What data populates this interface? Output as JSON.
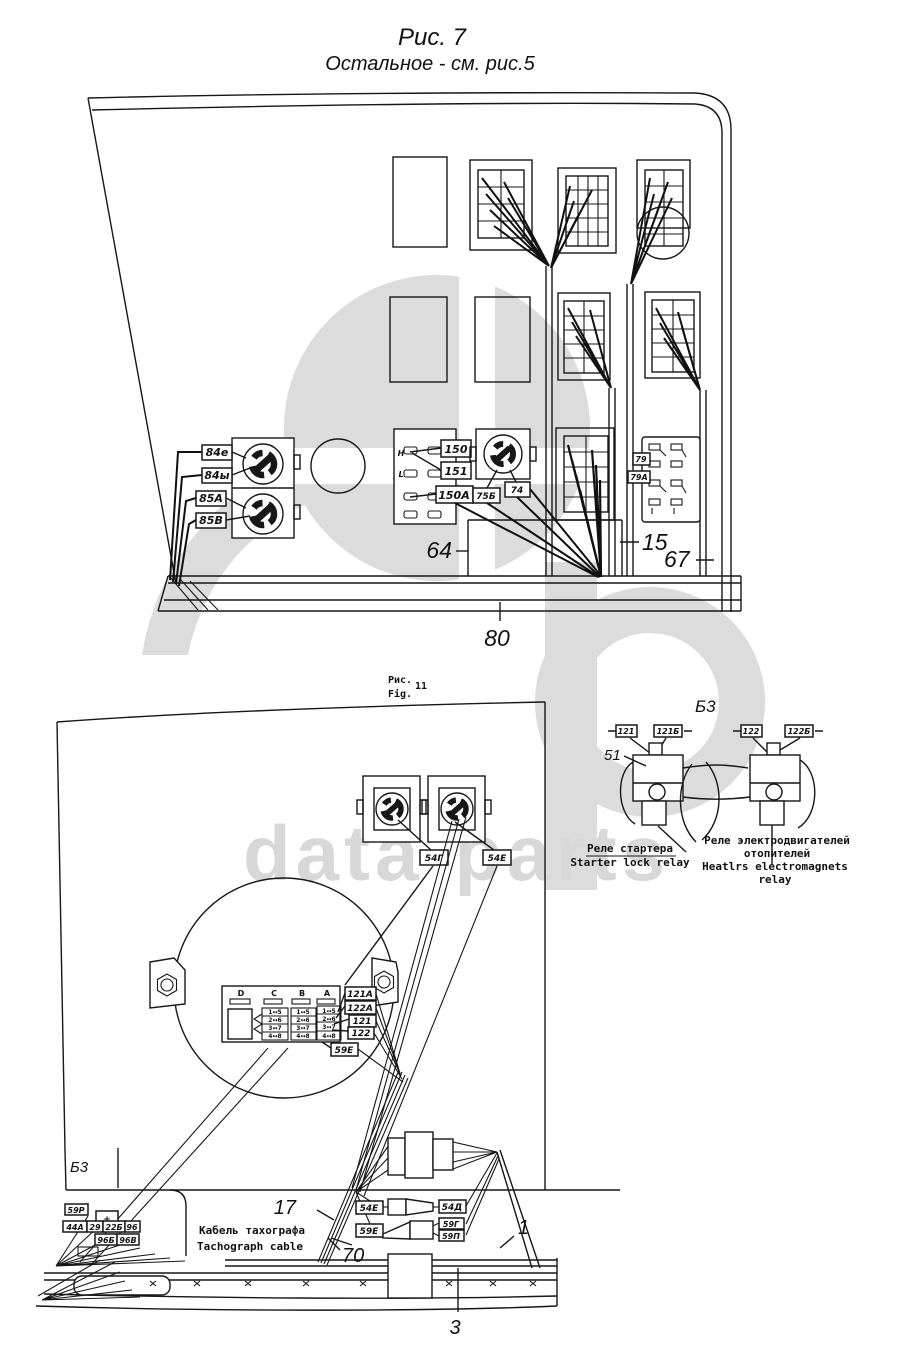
{
  "watermark": {
    "text": "data-parts"
  },
  "titles": {
    "fig7_line1": "Рис. 7",
    "fig7_line2": "Остальное - см. рис.5"
  },
  "fig7": {
    "left_labels": [
      "84е",
      "84ы",
      "85А",
      "85В"
    ],
    "switch_labels": [
      "150",
      "151",
      "150А"
    ],
    "mid_labels": [
      "75Б",
      "74"
    ],
    "conn_labels": [
      "79",
      "79А"
    ],
    "panel_marks": [
      "Н",
      "L"
    ],
    "numbers": {
      "duct": "64",
      "panel": "15",
      "pillar": "67",
      "sill": "80"
    }
  },
  "fig11": {
    "caption": {
      "ru": "Рис.",
      "en": "Fig.",
      "num": "11"
    },
    "b3_left": "Б3",
    "top_conn_labels": [
      "54Г",
      "54Е"
    ],
    "plate": {
      "columns": [
        "D",
        "C",
        "B",
        "A"
      ],
      "rows": [
        "1↔5",
        "2↔6",
        "3↔7",
        "4↔8"
      ]
    },
    "plate_labels": [
      "121А",
      "122А",
      "121",
      "122",
      "59Е"
    ],
    "mid_conn": {
      "l1": "54Е",
      "r1": "54Д",
      "l2": "59Е",
      "r2a": "59Г",
      "r2b": "59П"
    },
    "corner_labels": {
      "a": "59Р",
      "plus": "+",
      "b": "44А",
      "c": "29",
      "d": "22Б",
      "e": "96",
      "f": "96Б",
      "g": "96В"
    },
    "cable": {
      "ru": "Кабель тахографа",
      "en": "Tachograph cable"
    },
    "numbers": {
      "bundle": "17",
      "bundle2": "70",
      "harness": "1",
      "tray": "3"
    }
  },
  "b3": {
    "title": "Б3",
    "relay_number": "51",
    "relay1_pins": [
      "121",
      "121Б"
    ],
    "relay2_pins": [
      "122",
      "122Б"
    ],
    "caption1": {
      "ru": "Реле стартера",
      "en": "Starter lock relay"
    },
    "caption2": {
      "ru1": "Реле электродвигателей",
      "ru2": "отопителей",
      "en1": "Heatlrs electromagnets",
      "en2": "relay"
    }
  }
}
